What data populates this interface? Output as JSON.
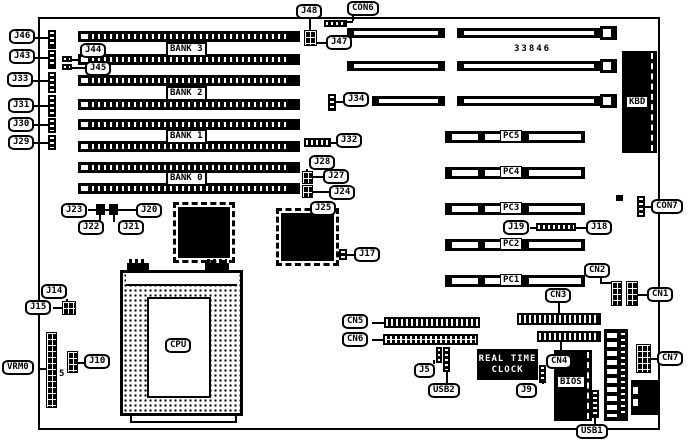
{
  "diagram": {
    "part_number": "33846",
    "labels": {
      "j46": "J46",
      "j43": "J43",
      "j33": "J33",
      "j31": "J31",
      "j30": "J30",
      "j29": "J29",
      "j44": "J44",
      "j45": "J45",
      "j48": "J48",
      "con6": "CON6",
      "j47": "J47",
      "j34": "J34",
      "bank3": "BANK 3",
      "bank2": "BANK 2",
      "bank1": "BANK 1",
      "bank0": "BANK 0",
      "kbd": "KBD",
      "pc5": "PC5",
      "pc4": "PC4",
      "pc3": "PC3",
      "pc2": "PC2",
      "pc1": "PC1",
      "j19": "J19",
      "j18": "J18",
      "con7": "CON7",
      "cn1": "CN1",
      "cn2": "CN2",
      "cn3": "CN3",
      "cn4": "CN4",
      "cn5": "CN5",
      "cn6": "CN6",
      "cn7": "CN7",
      "j32": "J32",
      "j28": "J28",
      "j27": "J27",
      "j24": "J24",
      "j25": "J25",
      "j17": "J17",
      "j23": "J23",
      "j22": "J22",
      "j21": "J21",
      "j20": "J20",
      "cpu": "CPU",
      "j14": "J14",
      "j15": "J15",
      "j10": "J10",
      "vrm": "VRM0",
      "vrm_pin": "5",
      "j5": "J5",
      "usb2": "USB2",
      "usb1": "USB1",
      "j9": "J9",
      "bios": "BIOS",
      "rtc_line1": "REAL TIME",
      "rtc_line2": "CLOCK"
    }
  }
}
